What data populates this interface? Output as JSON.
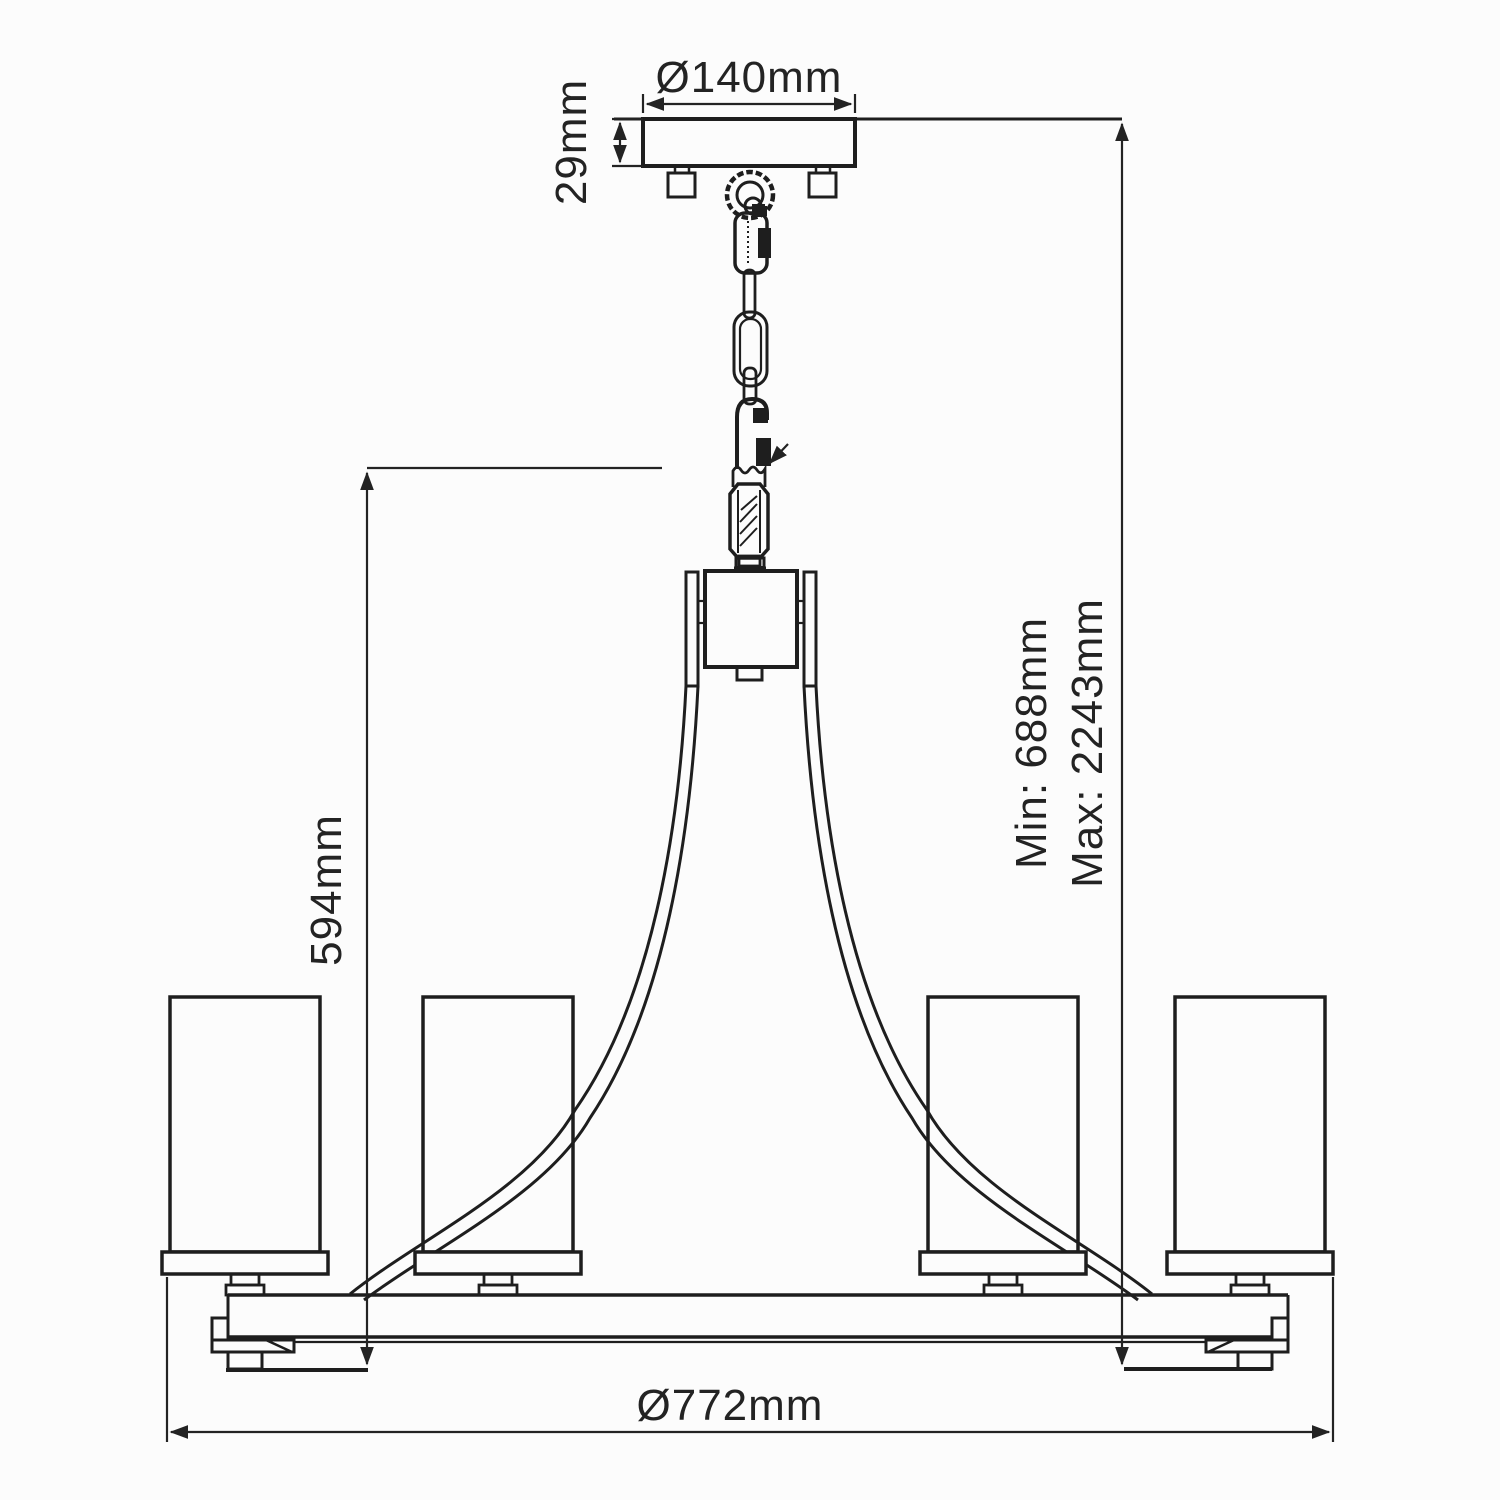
{
  "drawing": {
    "kind": "chandelier-dimension-diagram",
    "lights_shown": 4
  },
  "dimensions": {
    "canopy_diameter": "Ø140mm",
    "canopy_height": "29mm",
    "body_height": "594mm",
    "suspension_min": "Min: 688mm",
    "suspension_max": "Max: 2243mm",
    "overall_diameter": "Ø772mm"
  },
  "colors": {
    "line_color": "#1e1e1e",
    "dim_color": "#232323",
    "background": "#fcfcfc"
  }
}
